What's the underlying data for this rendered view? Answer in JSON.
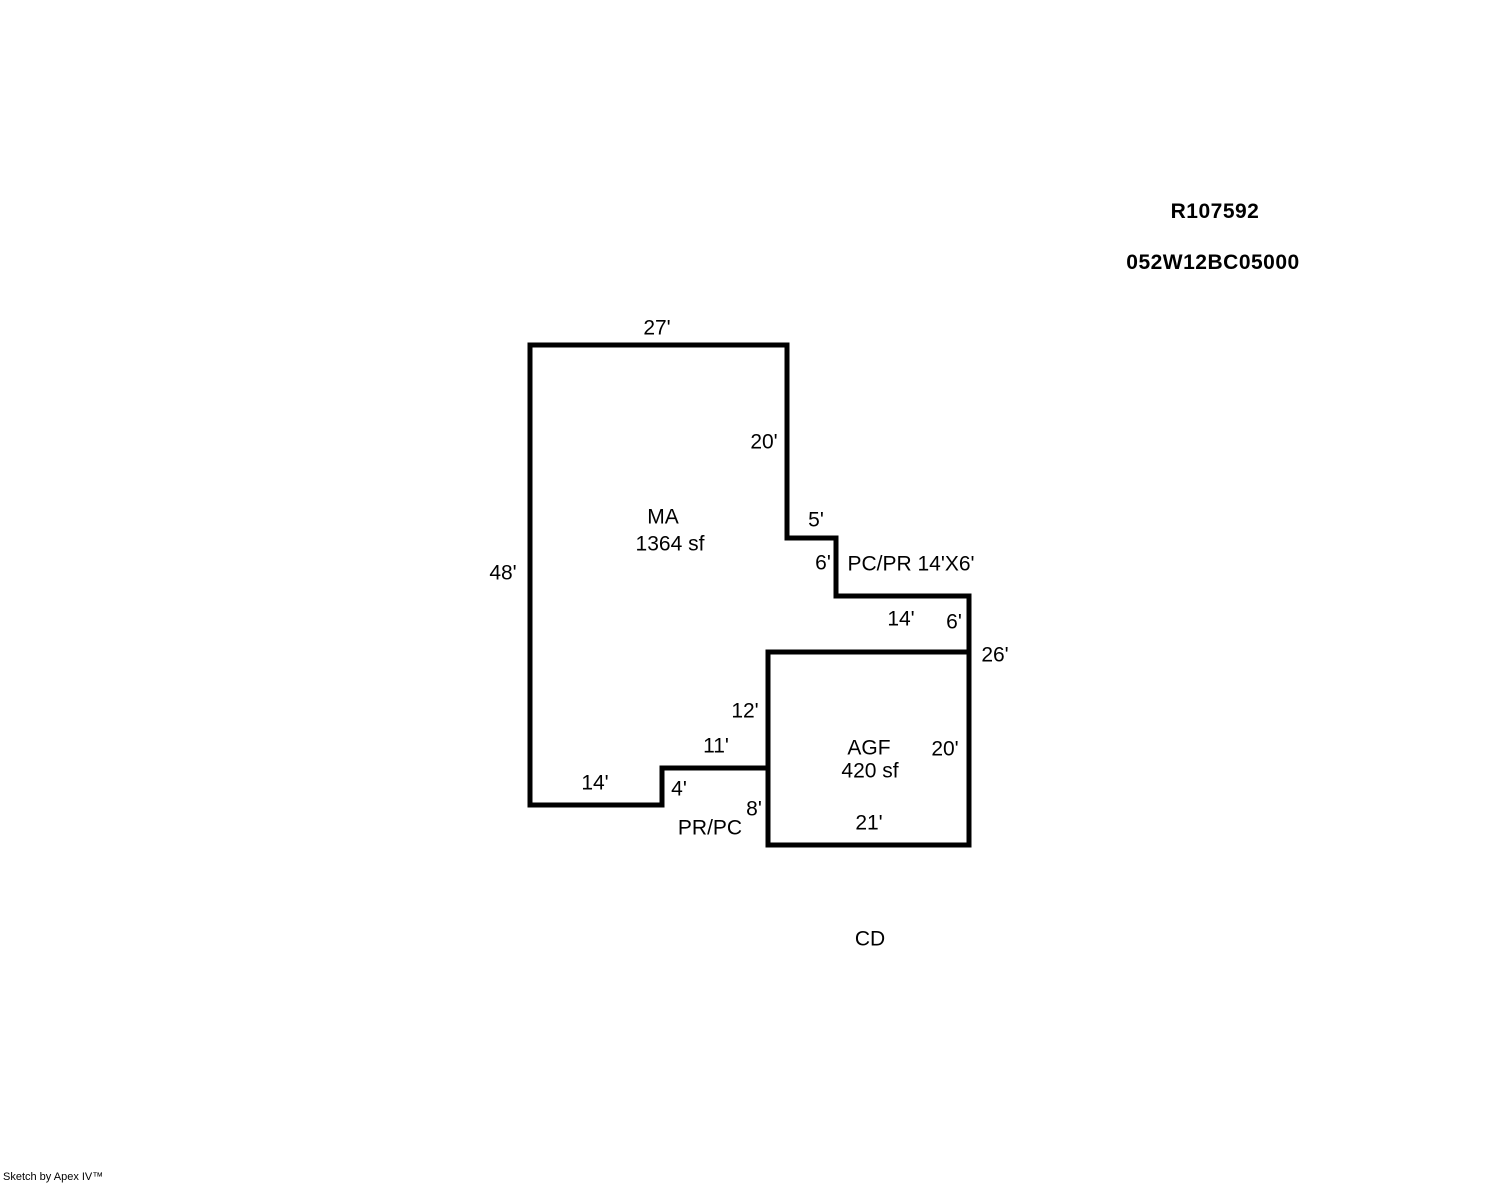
{
  "header": {
    "record_number": "R107592",
    "parcel_number": "052W12BC05000"
  },
  "footer": {
    "credit": "Sketch by Apex IV™"
  },
  "sketch": {
    "ink_color": "#000000",
    "background_color": "#ffffff",
    "line_width": 5,
    "shapes": [
      {
        "name": "ma-outline",
        "area_code": "MA",
        "area_sf": "1364 sf",
        "points": [
          [
            530,
            345
          ],
          [
            787,
            345
          ],
          [
            787,
            538
          ],
          [
            836,
            538
          ],
          [
            836,
            596
          ],
          [
            969,
            596
          ],
          [
            969,
            652
          ],
          [
            768,
            652
          ],
          [
            768,
            768
          ],
          [
            662,
            768
          ],
          [
            662,
            805
          ],
          [
            530,
            805
          ]
        ]
      },
      {
        "name": "agf-outline",
        "area_code": "AGF",
        "area_sf": "420 sf",
        "points": [
          [
            768,
            652
          ],
          [
            969,
            652
          ],
          [
            969,
            845
          ],
          [
            768,
            845
          ]
        ]
      }
    ],
    "labels": [
      {
        "name": "dim-ma-top-27",
        "text": "27'",
        "x": 657,
        "y": 327
      },
      {
        "name": "dim-ma-right-20",
        "text": "20'",
        "x": 764,
        "y": 441
      },
      {
        "name": "area-ma-code",
        "text": "MA",
        "x": 663,
        "y": 516
      },
      {
        "name": "area-ma-sqft",
        "text": "1364 sf",
        "x": 670,
        "y": 543
      },
      {
        "name": "dim-ma-left-48",
        "text": "48'",
        "x": 503,
        "y": 572
      },
      {
        "name": "dim-step-5",
        "text": "5'",
        "x": 816,
        "y": 519
      },
      {
        "name": "dim-step-6",
        "text": "6'",
        "x": 823,
        "y": 562
      },
      {
        "name": "note-pcpr",
        "text": "PC/PR 14'X6'",
        "x": 911,
        "y": 563
      },
      {
        "name": "dim-pcpr-14",
        "text": "14'",
        "x": 901,
        "y": 618
      },
      {
        "name": "dim-pcpr-6",
        "text": "6'",
        "x": 954,
        "y": 621
      },
      {
        "name": "dim-right-26",
        "text": "26'",
        "x": 995,
        "y": 654
      },
      {
        "name": "dim-agf-left-12",
        "text": "12'",
        "x": 745,
        "y": 710
      },
      {
        "name": "dim-ma-bottom-11",
        "text": "11'",
        "x": 716,
        "y": 745
      },
      {
        "name": "area-agf-code",
        "text": "AGF",
        "x": 869,
        "y": 747
      },
      {
        "name": "area-agf-sqft",
        "text": "420 sf",
        "x": 870,
        "y": 770
      },
      {
        "name": "dim-agf-right-20",
        "text": "20'",
        "x": 945,
        "y": 748
      },
      {
        "name": "dim-step-4",
        "text": "4'",
        "x": 679,
        "y": 788
      },
      {
        "name": "dim-ma-bottom-14",
        "text": "14'",
        "x": 595,
        "y": 782
      },
      {
        "name": "dim-agf-left-8",
        "text": "8'",
        "x": 754,
        "y": 808
      },
      {
        "name": "note-prpc",
        "text": "PR/PC",
        "x": 710,
        "y": 827
      },
      {
        "name": "dim-agf-bottom-21",
        "text": "21'",
        "x": 869,
        "y": 822
      },
      {
        "name": "area-cd-code",
        "text": "CD",
        "x": 870,
        "y": 938
      }
    ]
  }
}
